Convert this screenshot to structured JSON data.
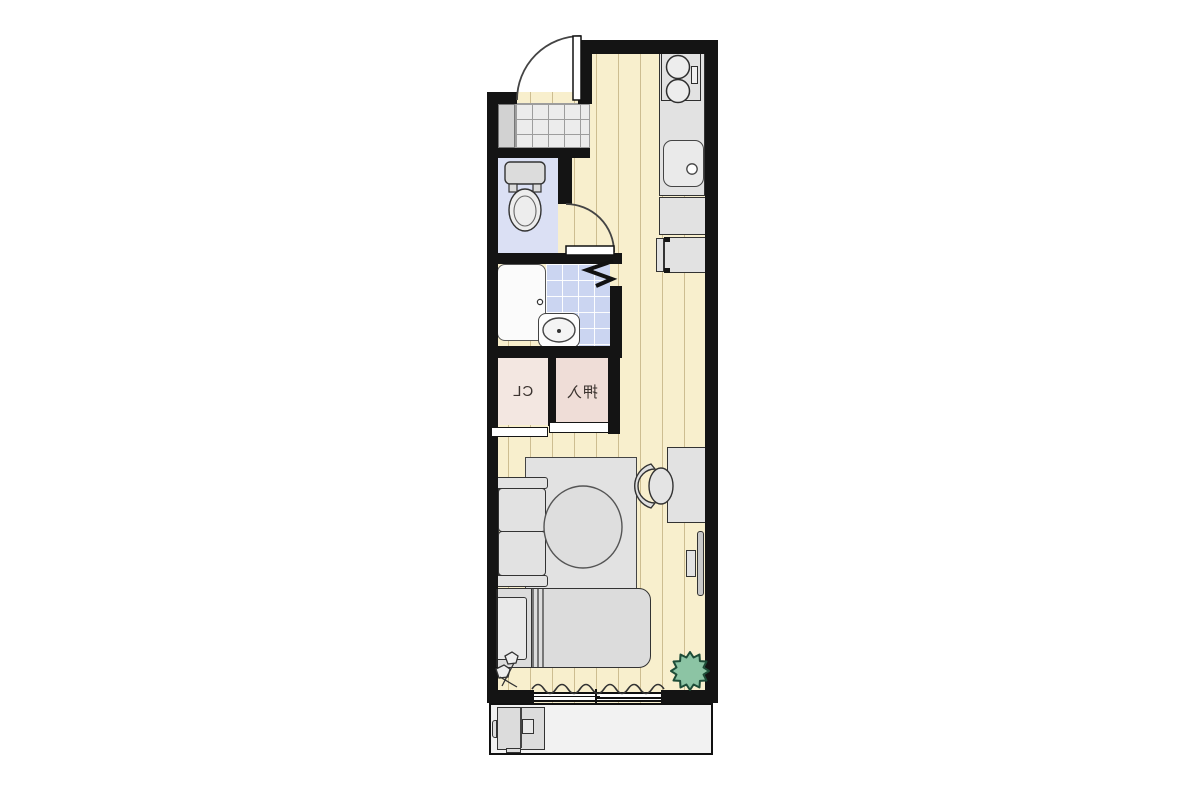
{
  "floor_plan": {
    "labels": {
      "closet": "CL",
      "oshiire": "押入"
    },
    "labels_mirrored": true,
    "colors": {
      "wall": "#141414",
      "floor": "#f8efcd",
      "floor_plank_line": "#aa945f",
      "genkan_tile": "#ececec",
      "toilet_room": "#dbe0f4",
      "bath_tile": "#cbd5f1",
      "closet_cl": "#f3e7e1",
      "closet_oshiire": "#efddd7",
      "furniture_gray": "#e2e2e2",
      "plant_green": "#8cc4a4",
      "balcony": "#f2f2f2",
      "background": "#ffffff"
    }
  }
}
